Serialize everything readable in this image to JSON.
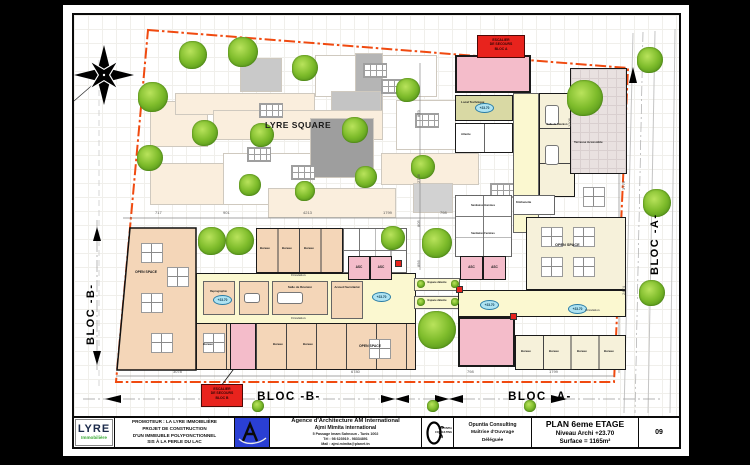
{
  "plan": {
    "site_label": "LYRE SQUARE",
    "level_marker": "+23.70",
    "bloc_a": "BLOC -A-",
    "bloc_b": "BLOC -B-"
  },
  "stair_boxes": {
    "a": {
      "l1": "ESCALIER",
      "l2": "DE SECOURS",
      "l3": "BLOC A"
    },
    "b": {
      "l1": "ESCALIER",
      "l2": "DE SECOURS",
      "l3": "BLOC B"
    }
  },
  "rooms": {
    "open_space": "OPEN SPACE",
    "bureau": "Bureau",
    "salle_reunion": "Salle de Réunion",
    "accueil": "Accueil Secrétariat",
    "circulation": "Circulation",
    "espace_detente": "Espace détente",
    "local_technique": "Local Technique",
    "terrasse": "Terrasse Accessible",
    "sanitaires_h": "Sanitaires Hommes",
    "sanitaires_f": "Sanitaires Femmes",
    "kitchenette": "Kitchenette",
    "attente": "Attente",
    "reprographie": "Reprographie",
    "asc": "ASC"
  },
  "dims": {
    "top": [
      "717",
      "901",
      "4213",
      "1799",
      "798"
    ],
    "bottom": [
      "3078",
      "6780",
      "798",
      "1799"
    ],
    "right": [
      "1206",
      "3779",
      "2474"
    ],
    "mid": [
      "879",
      "2706",
      "805",
      "856"
    ]
  },
  "title_block": {
    "lyre_logo": {
      "name": "LYRE",
      "sub": "Immobilière"
    },
    "promoter_lines": [
      "PROMOTEUR : LA LYRE IMMOBILIÈRE",
      "PROJET DE CONSTRUCTION",
      "D'UN IMMEUBLE POLYFONCTIONNEL",
      "SIS À LA PERLE DU LAC"
    ],
    "agency_lines": [
      "Agence d'Architecture AM International",
      "Ajmi Mimita international",
      "5 Passage Imam Sahnoun - Tunis 1002",
      "Tél : 98 623919 - 98334891",
      "Mail : ajmi.mimita@planet.tn"
    ],
    "opuntia_logo": {
      "top": "OPUNTIA",
      "bottom": "CONSULTING"
    },
    "opuntia_lines": [
      "Opuntia Consulting",
      "Maîtrise d'Ouvrage",
      "Déléguée"
    ],
    "plan_title": "PLAN 6eme ETAGE",
    "plan_level": "Niveau Archi +23.70",
    "plan_surface": "Surface = 1165m²",
    "page_number": "09"
  },
  "colors": {
    "boundary": "#F04A10",
    "stair_pink": "#F4BCCA",
    "corridor_yellow": "#FBF8D0",
    "office_peach": "#F4D6B8",
    "open_cream": "#F6F1DA",
    "tech_olive": "#D9D9A4",
    "tree_green": "#7EBC2B",
    "alert_red": "#E8231D",
    "brand_green": "#3AAA35",
    "brand_navy": "#1C2E52",
    "arch_blue": "#2A3FD4"
  }
}
